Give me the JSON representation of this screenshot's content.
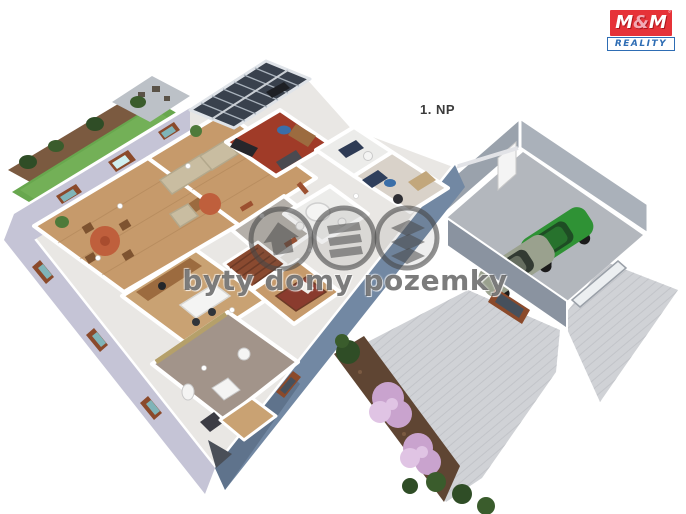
{
  "page": {
    "background": "#ffffff",
    "floor_label": "1. NP"
  },
  "watermark": {
    "text": "byty domy pozemky",
    "icons": [
      "house-icon",
      "floors-icon",
      "plots-icon"
    ]
  },
  "logo": {
    "m_left": "M",
    "ampersand": "&",
    "m_right": "M",
    "reality": "REALITY",
    "holding": "HOLDING"
  },
  "colors": {
    "logo_red": "#e63238",
    "logo_blue": "#2e6db4",
    "base": "#e9e7e4",
    "wall": "#ffffff",
    "lavender": "#c5c4d6",
    "slate": "#7288a3",
    "slate_dark": "#55687f",
    "wood": "#c69a6b",
    "wood2": "#c9a273",
    "plank": "#a87e52",
    "red_floor": "#a03b28",
    "hall_floor": "#b5b0aa",
    "bath_floor": "#ececea",
    "taupe_floor": "#a2948a",
    "pale_floor": "#d9d2c9",
    "khaki": "#b5a06a",
    "grass": "#68a74e",
    "grass_light": "#7cb65e",
    "path": "#7b5a40",
    "tree": "#2f4d26",
    "tree2": "#3a5c2c",
    "terrace": "#bcc1c7",
    "roof_dark": "#39414d",
    "roof_frame": "#dfe3e8",
    "roof_line": "#aab3bd",
    "frame_brown": "#8b4a2b",
    "glass_teal": "#7fb4b8",
    "glass_dark": "#46505c",
    "door_tc": "#9c5030",
    "table_tc": "#bf5f3c",
    "sofa": "#c9bda1",
    "sofa_dark": "#b3a88c",
    "furn_brown": "#9c6b3f",
    "furn_dark": "#26262b",
    "rug_blue": "#3a6ea8",
    "bed_maroon": "#8a3b2e",
    "stairs": "#8a4a30",
    "stairs_line": "#6d3a26",
    "garage_wall": "#9aa2ac",
    "garage_wall2": "#aab1ba",
    "garage_front": "#8a93a0",
    "garage_floor": "#b3b7bd",
    "drive": "#d0d2d6",
    "drive_line": "#c2c4c9",
    "soil": "#5f4533",
    "flower_pink": "#c9a3ce",
    "flower_light": "#e0c4e4",
    "car_green": "#2f9235",
    "car_green_dark": "#1e4d24",
    "car_olive": "#9aa18e",
    "car_window": "#333b33",
    "wheel": "#1b1b1b",
    "fixture": "#f4f4f3",
    "wm_gray": "rgba(72,72,72,0.6)"
  }
}
